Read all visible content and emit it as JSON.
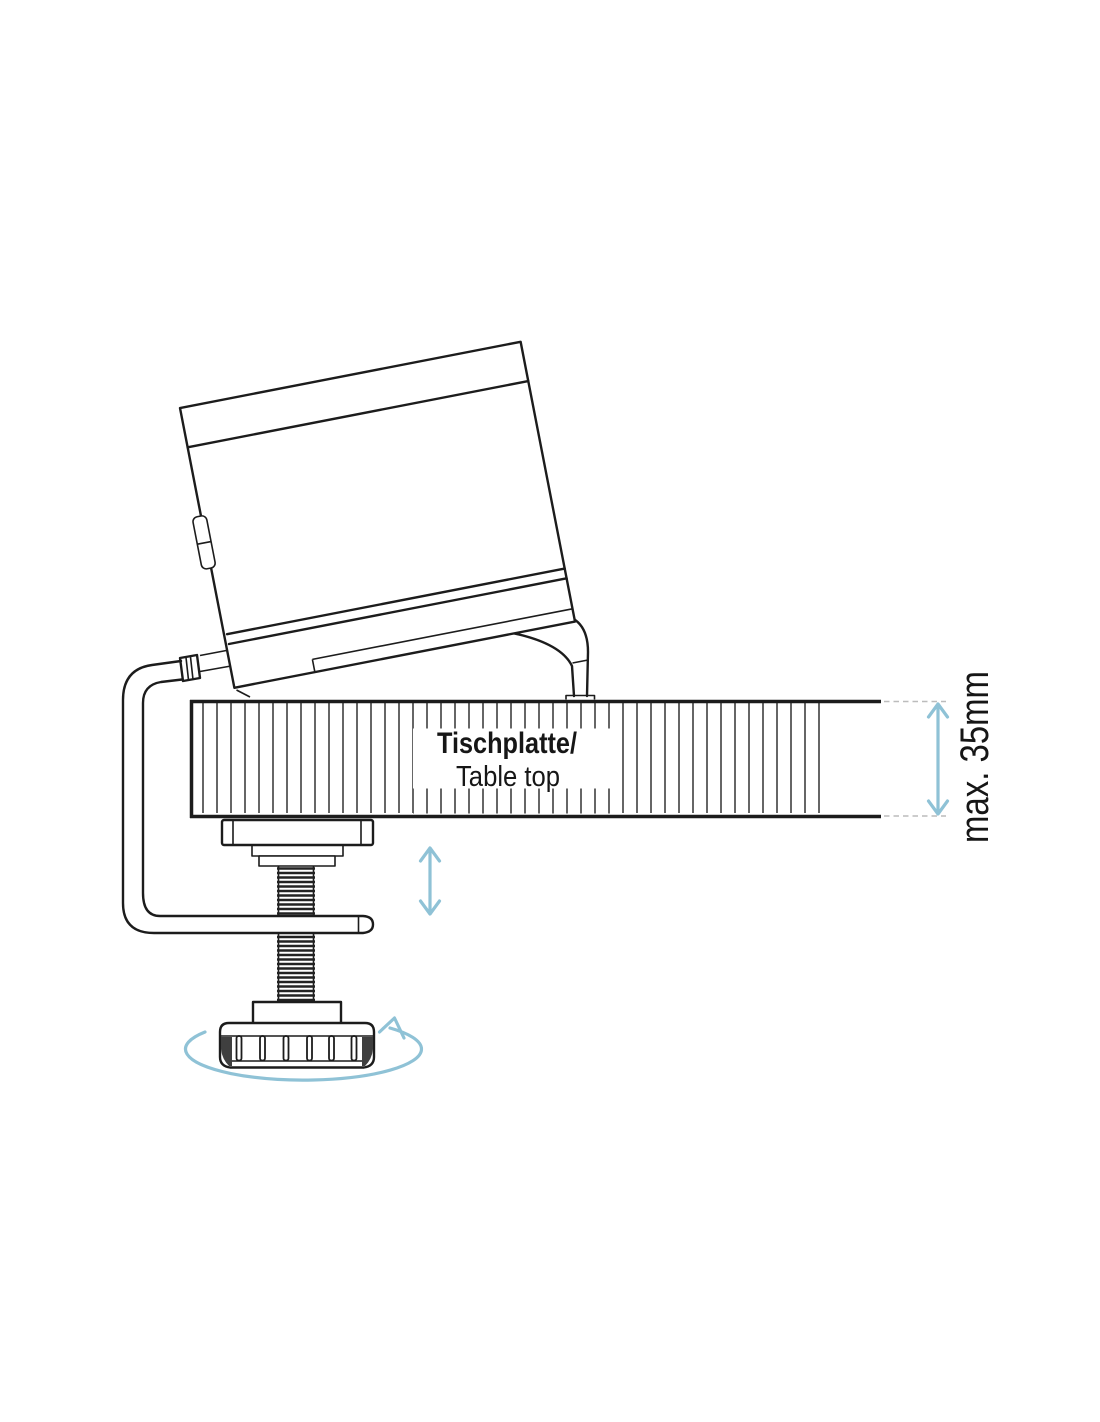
{
  "diagram": {
    "table_label_primary": "Tischplatte/",
    "table_label_secondary": "Table top",
    "dimension_label": "max. 35mm"
  },
  "colors": {
    "outline": "#1c1c1c",
    "hatch_line": "#4b4b4b",
    "accent_arrow": "#8fc2d6",
    "extension_dash": "#bcbcbc"
  },
  "icons": {
    "knob_rotation_arrow": "elliptical-counterclockwise-arrow",
    "screw_travel_arrow": "vertical-double-arrow",
    "thickness_dimension_arrow": "vertical-double-arrow"
  }
}
